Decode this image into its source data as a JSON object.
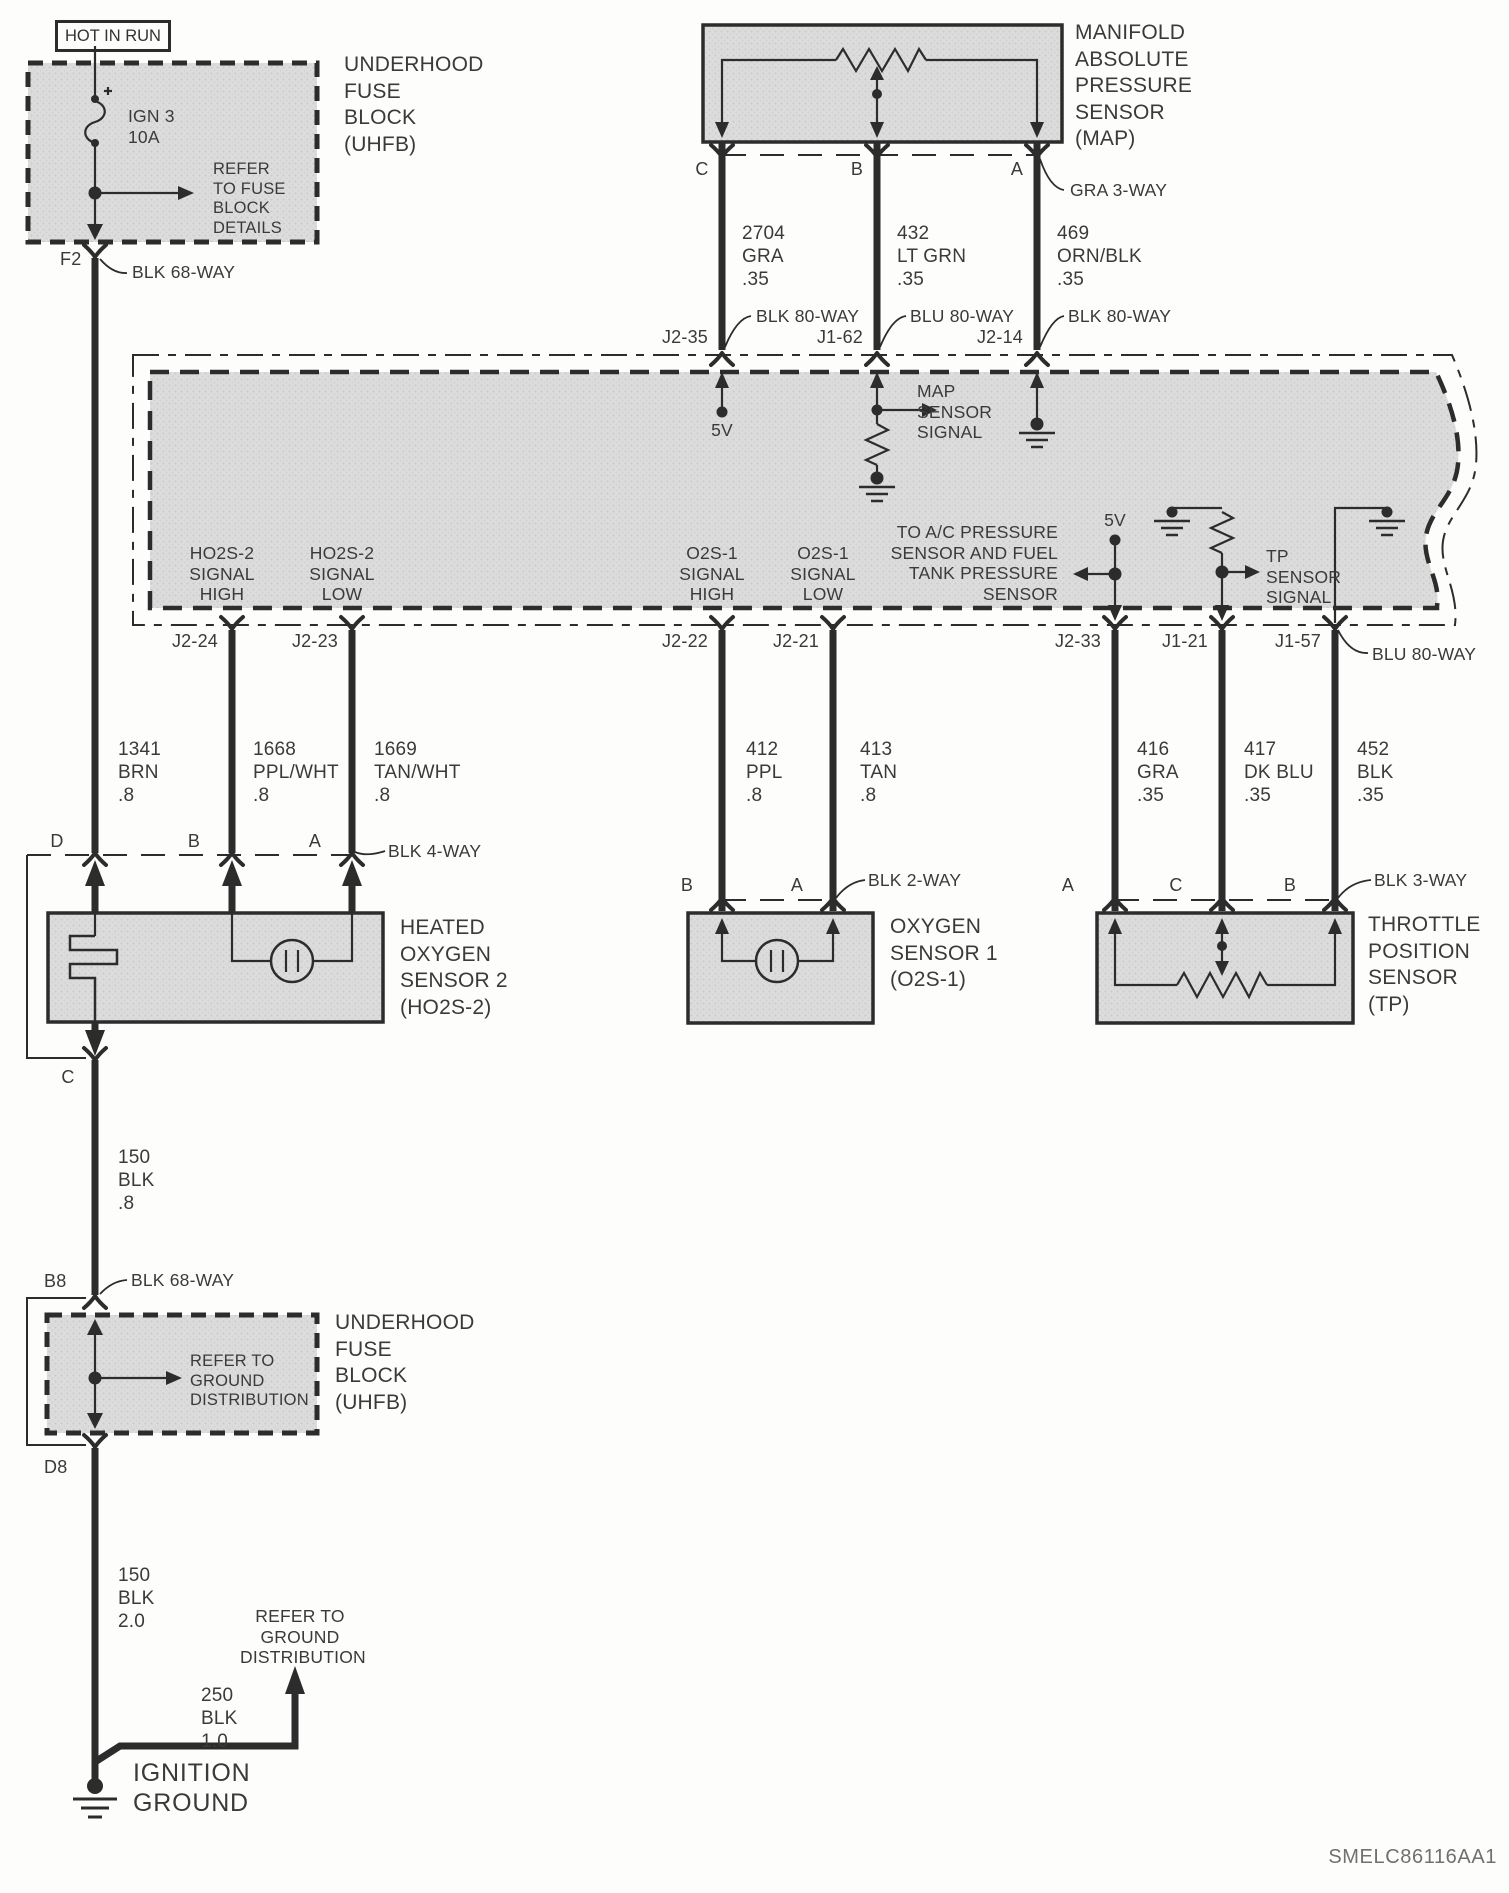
{
  "colors": {
    "ink": "#2c2c2c",
    "shade": "#dcdcdc",
    "text": "#3a3a3a"
  },
  "code": "SMELC86116AA1",
  "power": {
    "label": "HOT IN RUN"
  },
  "uhfb_top": {
    "title": "UNDERHOOD\nFUSE\nBLOCK\n(UHFB)",
    "fuse": "IGN 3\n10A",
    "note": "REFER\nTO FUSE\nBLOCK\nDETAILS",
    "pin": "F2",
    "connector": "BLK 68-WAY"
  },
  "map": {
    "title": "MANIFOLD\nABSOLUTE\nPRESSURE\nSENSOR\n(MAP)",
    "connector": "GRA 3-WAY",
    "pins": [
      "C",
      "B",
      "A"
    ],
    "wires": [
      "2704\nGRA\n.35",
      "432\nLT GRN\n.35",
      "469\nORN/BLK\n.35"
    ]
  },
  "ecm": {
    "top_pins": [
      "J2-35",
      "J1-62",
      "J2-14"
    ],
    "top_connectors": [
      "BLK 80-WAY",
      "BLU 80-WAY",
      "BLK 80-WAY"
    ],
    "five_v_top": "5V",
    "map_signal": "MAP\nSENSOR\nSIGNAL",
    "signals": [
      "HO2S-2\nSIGNAL\nHIGH",
      "HO2S-2\nSIGNAL\nLOW",
      "O2S-1\nSIGNAL\nHIGH",
      "O2S-1\nSIGNAL\nLOW"
    ],
    "ac_note": "TO A/C PRESSURE\nSENSOR AND FUEL\nTANK PRESSURE\nSENSOR",
    "five_v_right": "5V",
    "tp_signal": "TP\nSENSOR\nSIGNAL",
    "bottom_pins": [
      "J2-24",
      "J2-23",
      "J2-22",
      "J2-21",
      "J2-33",
      "J1-21",
      "J1-57"
    ],
    "bottom_connector": "BLU 80-WAY"
  },
  "wires_mid": [
    "1341\nBRN\n.8",
    "1668\nPPL/WHT\n.8",
    "1669\nTAN/WHT\n.8",
    "412\nPPL\n.8",
    "413\nTAN\n.8",
    "416\nGRA\n.35",
    "417\nDK BLU\n.35",
    "452\nBLK\n.35"
  ],
  "ho2s2": {
    "title": "HEATED\nOXYGEN\nSENSOR 2\n(HO2S-2)",
    "pins": [
      "D",
      "B",
      "A"
    ],
    "connector": "BLK 4-WAY",
    "bottom_pin": "C"
  },
  "o2s1": {
    "title": "OXYGEN\nSENSOR 1\n(O2S-1)",
    "pins": [
      "B",
      "A"
    ],
    "connector": "BLK 2-WAY"
  },
  "tp": {
    "title": "THROTTLE\nPOSITION\nSENSOR\n(TP)",
    "pins": [
      "A",
      "C",
      "B"
    ],
    "connector": "BLK 3-WAY"
  },
  "ground": {
    "wire_upper": "150\nBLK\n.8",
    "pin_b8": "B8",
    "connector_b8": "BLK 68-WAY",
    "uhfb_title": "UNDERHOOD\nFUSE\nBLOCK\n(UHFB)",
    "uhfb_note": "REFER TO\nGROUND\nDISTRIBUTION",
    "pin_d8": "D8",
    "wire_lower": "150\nBLK\n2.0",
    "wire_branch": "250\nBLK\n1.0",
    "dist_note": "REFER TO\nGROUND\nDISTRIBUTION",
    "label": "IGNITION\nGROUND"
  }
}
